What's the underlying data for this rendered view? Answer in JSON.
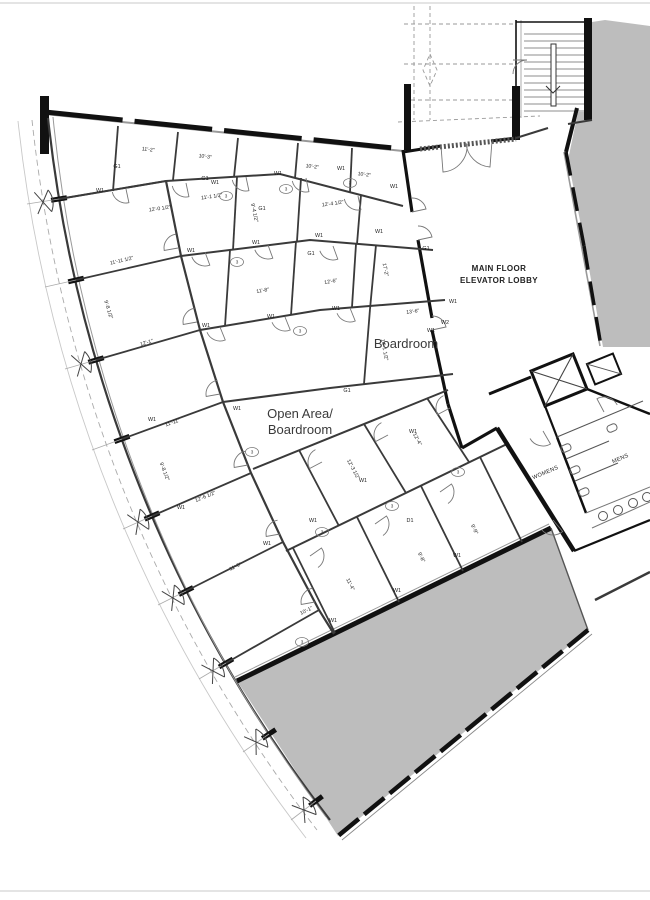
{
  "plan": {
    "colors": {
      "heavy_wall": "#111111",
      "partition": "#3a3a3a",
      "light_line": "#999999",
      "shaded_area": "#bdbdbd",
      "label_text": "#3a3a3a"
    },
    "room_labels": {
      "lobby_line1": "MAIN FLOOR",
      "lobby_line2": "ELEVATOR LOBBY",
      "boardroom": "Boardroom",
      "open_area_line1": "Open Area/",
      "open_area_line2": "Boardroom",
      "womens": "WOMENS",
      "mens": "MENS"
    },
    "dims": [
      {
        "t": "11'-2\""
      },
      {
        "t": "10'-2\""
      },
      {
        "t": "10'-2\""
      },
      {
        "t": "10'-3\""
      },
      {
        "t": "12'-0 1/2\""
      },
      {
        "t": "11'-1 1/2\""
      },
      {
        "t": "11'-11 1/2\""
      },
      {
        "t": "12'-1\""
      },
      {
        "t": "9'-8 1/2\""
      },
      {
        "t": "11'-11\""
      },
      {
        "t": "12'-6 1/2\""
      },
      {
        "t": "9'-8 1/2\""
      },
      {
        "t": "11'-9\""
      },
      {
        "t": "12'-4 1/2\""
      },
      {
        "t": "9'-4 1/2\""
      },
      {
        "t": "11'-8\""
      },
      {
        "t": "12'-6\""
      },
      {
        "t": "17'-2\""
      },
      {
        "t": "13'-6\""
      },
      {
        "t": "14'-1 1/2\""
      },
      {
        "t": "12'-3 1/2\""
      },
      {
        "t": "12'-4\""
      },
      {
        "t": "10'-1\""
      },
      {
        "t": "11'-4\""
      },
      {
        "t": "9'-8\""
      },
      {
        "t": "9'-9\""
      }
    ],
    "wall_tags": [
      {
        "t": "G1"
      },
      {
        "t": "W1"
      },
      {
        "t": "W1"
      },
      {
        "t": "W1"
      },
      {
        "t": "W1"
      },
      {
        "t": "W1"
      },
      {
        "t": "G1"
      },
      {
        "t": "W1"
      },
      {
        "t": "W1"
      },
      {
        "t": "W1"
      },
      {
        "t": "W1"
      },
      {
        "t": "G1"
      },
      {
        "t": "W1"
      },
      {
        "t": "W1"
      },
      {
        "t": "W1"
      },
      {
        "t": "G1"
      },
      {
        "t": "W1"
      },
      {
        "t": "W1"
      },
      {
        "t": "W1"
      },
      {
        "t": "W1"
      },
      {
        "t": "W1"
      },
      {
        "t": "W1"
      },
      {
        "t": "W1"
      },
      {
        "t": "G1"
      },
      {
        "t": "W2"
      },
      {
        "t": "W1"
      },
      {
        "t": "D1"
      },
      {
        "t": "W1"
      },
      {
        "t": "W1"
      },
      {
        "t": "W1"
      },
      {
        "t": "G1"
      },
      {
        "t": "W1"
      }
    ],
    "door_tags": [
      {
        "t": "3"
      },
      {
        "t": "3"
      },
      {
        "t": "3"
      },
      {
        "t": "3"
      },
      {
        "t": "3"
      },
      {
        "t": "3"
      },
      {
        "t": "3"
      },
      {
        "t": "3"
      },
      {
        "t": "3"
      },
      {
        "t": "3"
      }
    ]
  }
}
